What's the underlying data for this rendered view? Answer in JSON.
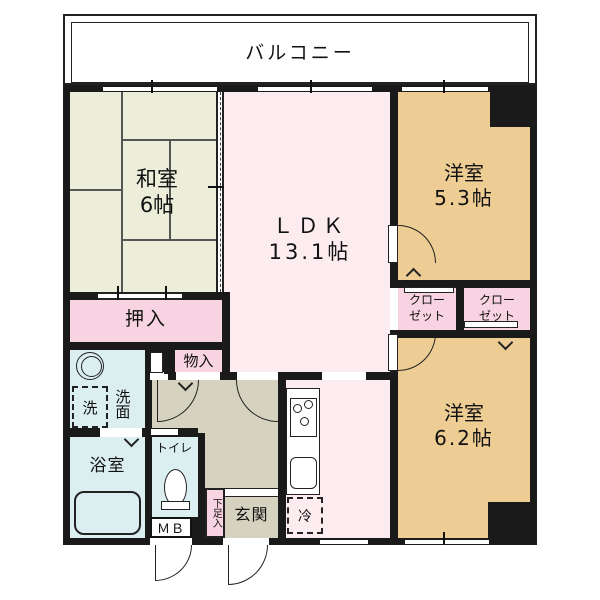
{
  "colors": {
    "wall": "#1a1a1a",
    "line": "#555555",
    "tatami_room": "#edeeda",
    "ldk": "#fcecef",
    "western_room": "#eecd94",
    "closet_pink": "#f8d4e2",
    "wet_area": "#dbeff1",
    "hall": "#d5d3bf"
  },
  "balcony": {
    "label": "バルコニー"
  },
  "rooms": {
    "washitsu": {
      "name": "和室",
      "size": "6帖"
    },
    "ldk": {
      "name": "ＬＤＫ",
      "size": "13.1帖"
    },
    "yoshitsu_53": {
      "name": "洋室",
      "size": "5.3帖"
    },
    "yoshitsu_62": {
      "name": "洋室",
      "size": "6.2帖"
    },
    "oshiire": {
      "label": "押入"
    },
    "monoire": {
      "label": "物入"
    },
    "closet_left": {
      "line1": "クロー",
      "line2": "ゼット"
    },
    "closet_right": {
      "line1": "クロー",
      "line2": "ゼット"
    },
    "senmen": {
      "label": "洗面"
    },
    "bath": {
      "label": "浴室"
    },
    "toilet": {
      "label": "トイレ"
    },
    "genkan": {
      "label": "玄関"
    },
    "shoe_cabinet": {
      "label": "下足入"
    },
    "meter_box": {
      "label": "ＭＢ"
    }
  },
  "fixtures": {
    "washer": {
      "label": "洗"
    },
    "fridge": {
      "label": "冷"
    }
  }
}
